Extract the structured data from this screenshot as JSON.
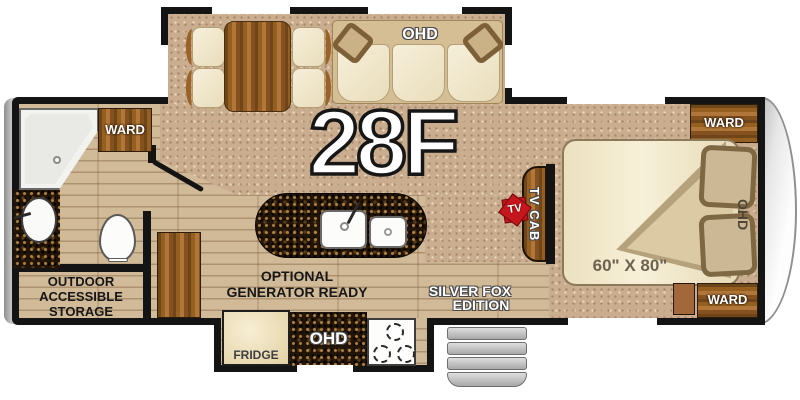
{
  "model": "28F",
  "edition": [
    "SILVER FOX",
    "EDITION"
  ],
  "labels": {
    "ohd_slideout": "OHD",
    "ward_bath": "WARD",
    "storage": [
      "OUTDOOR",
      "ACCESSIBLE",
      "STORAGE"
    ],
    "optional": [
      "OPTIONAL",
      "GENERATOR READY"
    ],
    "fridge": "FRIDGE",
    "ohd_kitchen": "OHD",
    "tv_cab": "TV CAB",
    "tv_badge": "TV",
    "ward_bedroom_top": "WARD",
    "ward_bedroom_bottom": "WARD",
    "ohd_bedroom": "OHD",
    "bed_size": "60\" X 80\""
  },
  "colors": {
    "wall": "#141414",
    "carpet": "#c9ad8e",
    "wood_floor": "#dcc6a5",
    "cabinet_wood": "#8a5524",
    "granite": "#221507",
    "upholstery": "#f2ecd8",
    "badge_red": "#c4161c",
    "steps": "#c9c9c9"
  }
}
